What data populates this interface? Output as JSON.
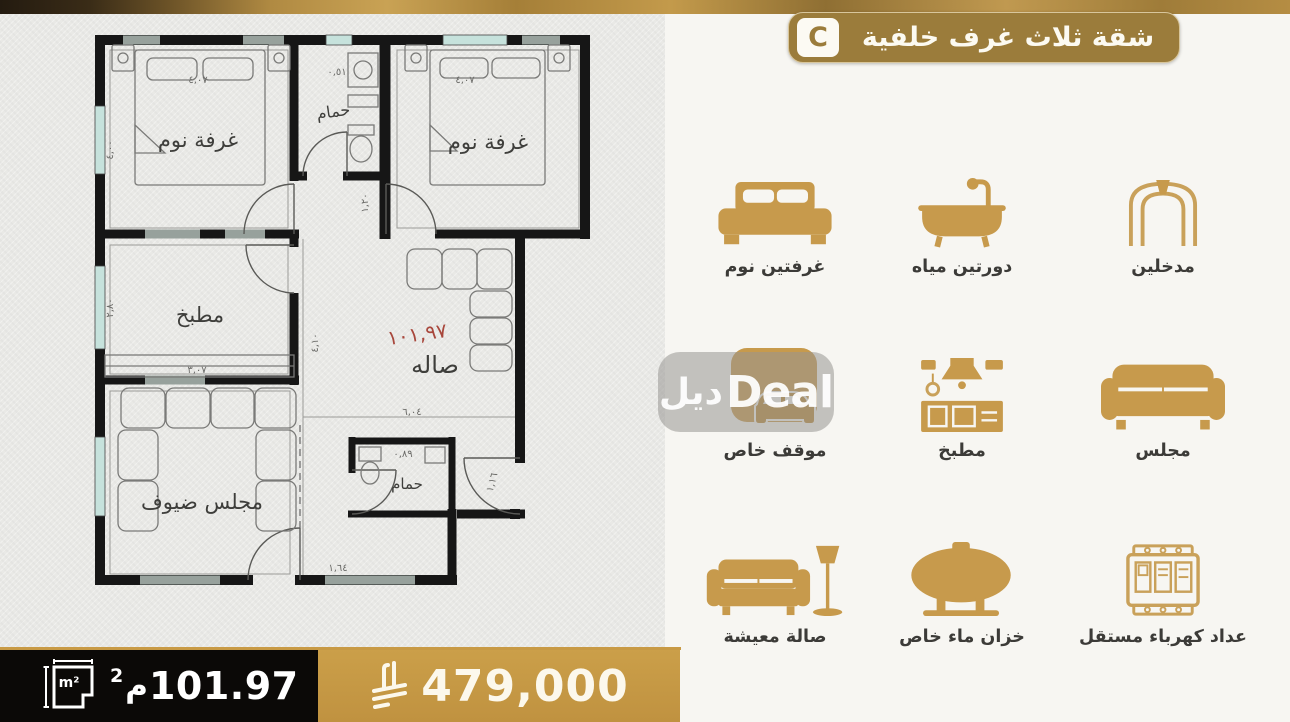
{
  "header": {
    "badge": "C",
    "title": "شقة ثلاث غرف خلفية"
  },
  "plan": {
    "bedroom1": "غرفة نوم",
    "bedroom2": "غرفة نوم",
    "bathroom1": "حمام",
    "bathroom2": "حمام",
    "kitchen": "مطبخ",
    "hall": "صاله",
    "majlis": "مجلس ضيوف",
    "area_red": "١٠١,٩٧",
    "dims": {
      "bed1": "٤,٠٧",
      "bed2": "٤,٠٧",
      "left_top": "٤,٠٠",
      "kitchen_left": "٢,٨٠",
      "kitchen_bottom": "٣,٠٧",
      "bath1_top": "٠,٥١",
      "corridor": "١,٢٠",
      "hall_left": "٤,١٠",
      "hall_bottom": "٦,٠٤",
      "bath2": "٠,٨٩",
      "entry_bottom": "١,٦٤",
      "entry_right": "١,١٦"
    }
  },
  "features": {
    "items": [
      {
        "name": "bedrooms",
        "icon": "bed-icon",
        "label": "غرفتين نوم"
      },
      {
        "name": "bathrooms",
        "icon": "bathtub-icon",
        "label": "دورتين مياه"
      },
      {
        "name": "entrances",
        "icon": "arch-icon",
        "label": "مدخلين"
      },
      {
        "name": "parking",
        "icon": "car-icon",
        "label": "موقف خاص"
      },
      {
        "name": "kitchen",
        "icon": "kitchen-icon",
        "label": "مطبخ"
      },
      {
        "name": "majlis",
        "icon": "sofa-icon",
        "label": "مجلس"
      },
      {
        "name": "living-room",
        "icon": "sofa-lamp-icon",
        "label": "صالة معيشة"
      },
      {
        "name": "water-tank",
        "icon": "water-tank-icon",
        "label": "خزان ماء خاص"
      },
      {
        "name": "electric-meter",
        "icon": "meter-icon",
        "label": "عداد كهرباء مستقل"
      }
    ]
  },
  "watermark": {
    "arabic": "ديل",
    "latin": "Deal"
  },
  "footer": {
    "area_value": "101.97",
    "area_unit_letter": "م",
    "area_sup": "2",
    "m2_icon_text": "m²",
    "price": "479,000",
    "currency_icon": "saudi-riyal-symbol"
  },
  "colors": {
    "gold": "#C79A4C",
    "bronze": "#9B7C3B",
    "black_bar": "#0B0907",
    "red": "#A8473C",
    "window_teal": "#C6E2DC"
  }
}
